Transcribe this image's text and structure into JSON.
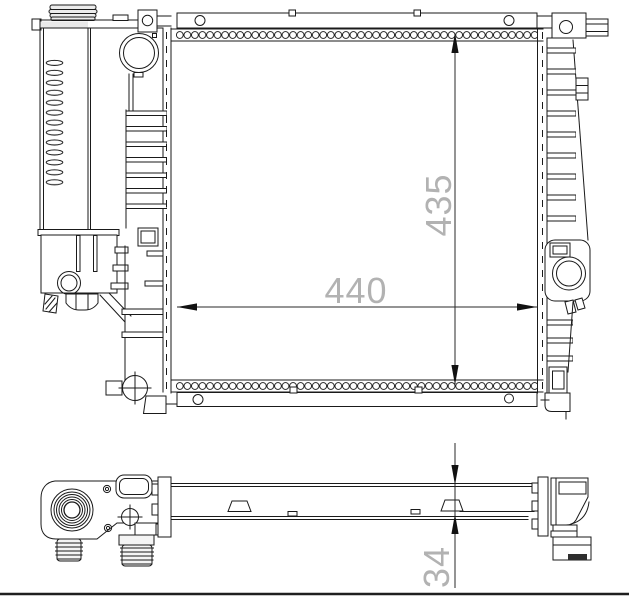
{
  "drawing": {
    "background": "#ffffff",
    "line_color": "#1a1a1a",
    "dim_line_color": "#2a2a2a",
    "dim_text_color": "#b2b2b2",
    "separator_color": "#1f1f1f",
    "dimensions": {
      "core_width": "440",
      "core_height": "435",
      "core_depth": "34"
    }
  }
}
